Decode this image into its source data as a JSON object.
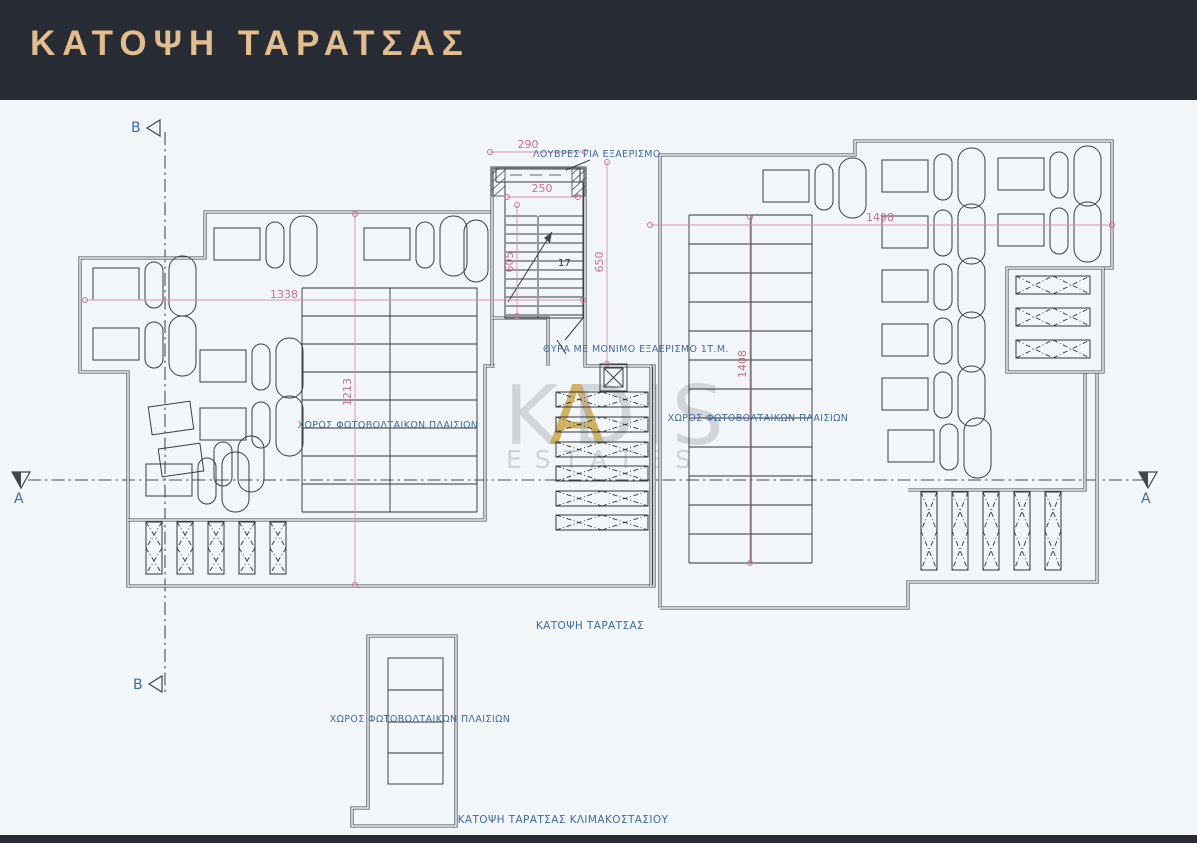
{
  "header": {
    "title": "ΚΑΤΟΨΗ ΤΑΡΑΤΣΑΣ"
  },
  "watermark": {
    "part1": "K",
    "part2": "A",
    "part3": "DIS",
    "sub": "ESTATES"
  },
  "plan": {
    "labels": {
      "louvres": "ΛΟΥΒΡΕΣ ΓΙΑ ΕΞΑΕΡΙΣΜΟ",
      "door_vent": "ΘΥΡΑ ΜΕ ΜΟΝΙΜΟ ΕΞΑΕΡΙΣΜΟ 1Τ.Μ.",
      "pv_area": "ΧΩΡΟΣ ΦΩΤΟΒΟΛΤΑΙΚΩΝ ΠΛΑΙΣΙΩΝ",
      "caption_main": "ΚΑΤΟΨΗ ΤΑΡΑΤΣΑΣ",
      "caption_stairwell": "ΚΑΤΟΨΗ ΤΑΡΑΤΣΑΣ ΚΛΙΜΑΚΟΣΤΑΣΙΟΥ"
    },
    "dimensions": {
      "top_width": "290",
      "stair_width": "250",
      "stair_height_left": "605",
      "stair_height_right": "650",
      "left_wing_width": "1338",
      "left_wing_height": "1213",
      "right_wing_width": "1498",
      "right_wing_height": "1408",
      "stair_steps": "17"
    },
    "section_markers": {
      "a": "A",
      "b": "B"
    },
    "colors": {
      "header_bg": "#282c35",
      "header_gold": "#e3bd8c",
      "canvas": "#f3f6f8",
      "line_dark": "#42464c",
      "dimension_pink": "#c9708e",
      "label_blue": "#3c6ba8",
      "watermark_gray": "#aeb4ba",
      "watermark_gold": "#c79a2e"
    }
  }
}
